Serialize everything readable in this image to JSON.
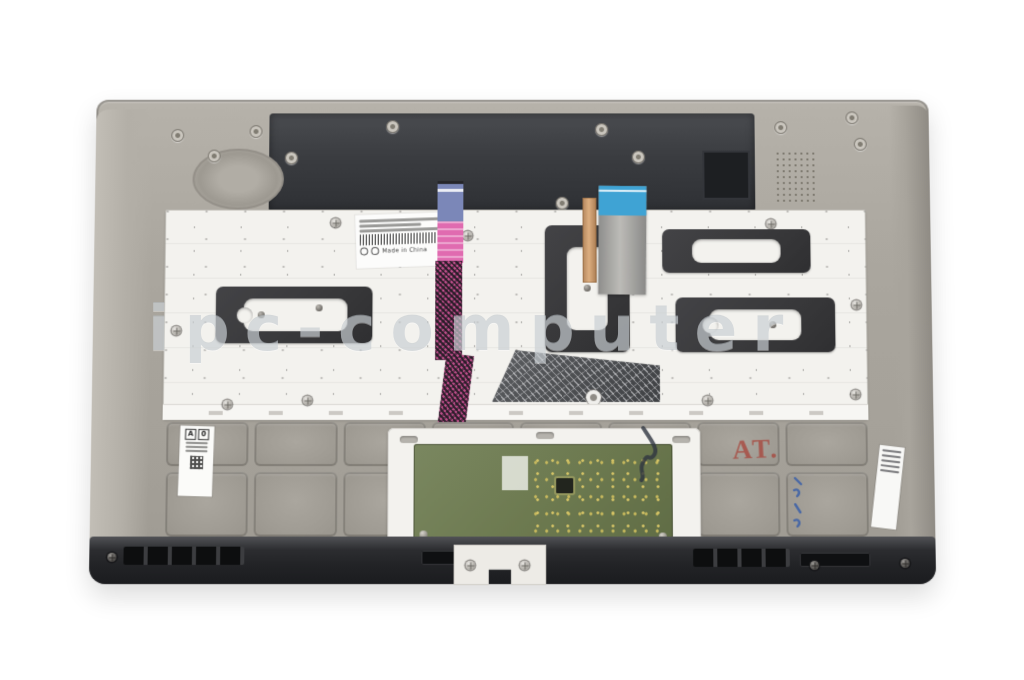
{
  "photo": {
    "subject": "Rear view photograph of a laptop palmrest keyboard assembly with touchpad module, ribbon cables and service labels",
    "watermark": "ipc-computer"
  },
  "labels": {
    "keyboard_label_country": "Made in China",
    "chassis_stamp": "AT.",
    "left_sticker_box_a": "A",
    "left_sticker_box_b": "0"
  },
  "colors": {
    "background": "#ffffff",
    "chassis_gray": "#aaa69e",
    "top_interior_dark": "#3a3c40",
    "keyboard_plate": "#f3f2ee",
    "adhesive_patch": "#38383a",
    "ribbon_pink": "#e06bb0",
    "ribbon_mesh": "#c14f8c",
    "stiffener_purple": "#7b87b8",
    "stiffener_cyan": "#3fa3d4",
    "stiffener_blue": "#4e7fd0",
    "copper_strip": "#c08a5e",
    "touchpad_pcb": "#6c794f",
    "bottom_trim": "#222326",
    "stamp_red": "#a73e34",
    "ink_blue": "#3a5fa8",
    "watermark_gray": "#b8bfc5"
  }
}
